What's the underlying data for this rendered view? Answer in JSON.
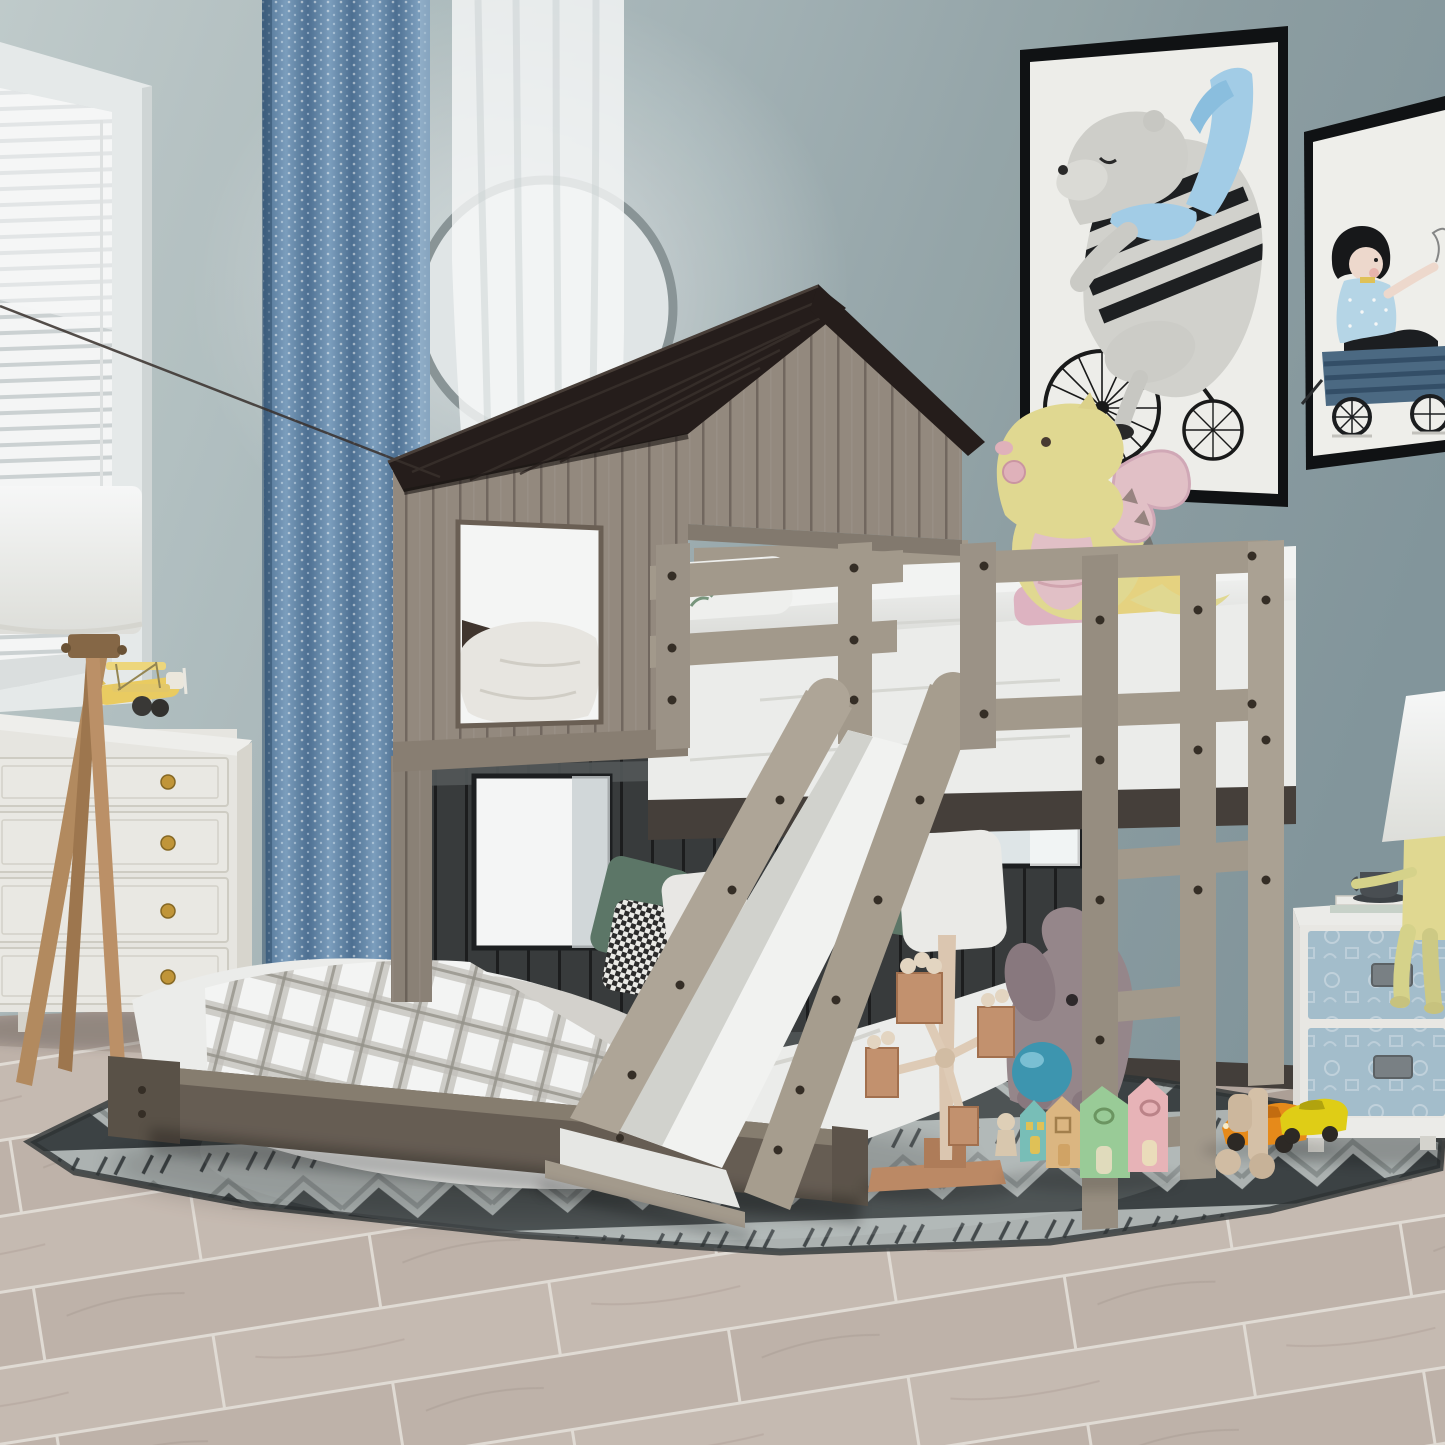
{
  "scene": {
    "description": "Product photo of a kids bedroom: rustic grey playhouse loft bunk bed with dark roof, wooden slide and ladder, full-size lower bed, toys on a grey chevron rug, white dresser with tripod lamp at left, blue nightstand at right, two framed nursery prints on a blue-grey wall.",
    "objects": [
      "venetian-blind-window",
      "blue-patterned-curtain",
      "white-sheer-curtain",
      "round-moon-wall-decor",
      "tripod-floor-lamp",
      "white-dresser",
      "yellow-toy-biplane",
      "bear-on-bicycle-framed-print",
      "boy-in-wagon-framed-print",
      "playhouse-loft-bunk-bed",
      "dark-shingle-roof",
      "upper-loft-mattress",
      "yellow-dragon-plush",
      "wooden-slide",
      "guardrail",
      "ladder",
      "lower-full-bed",
      "plaid-blanket",
      "bolster-pillow",
      "green-pillow",
      "houndstooth-pillow",
      "grey-chevron-rug",
      "plush-elephant",
      "blue-ball",
      "wooden-windmill-toy",
      "pastel-toy-houses",
      "wooden-peg-figure",
      "orange-toy-car",
      "yellow-toy-car",
      "stacked-wood-figure",
      "blue-two-drawer-nightstand",
      "sitting-man-table-lamp",
      "cup-and-books",
      "light-wood-plank-floor"
    ]
  },
  "palette": {
    "wall": "#a7b6b9",
    "wall_light": "#c6d1d1",
    "wall_dark": "#879aa0",
    "curtain_blue": "#5d81a6",
    "sheer": "#f6f8f8",
    "roof": "#261e1b",
    "house_wood": "#988d82",
    "house_wood_dark": "#8d8276",
    "bed_wood": "#a89e90",
    "dark_panel": "#3a3d3e",
    "mattress": "#f4f4f2",
    "slide_white": "#fafaf8",
    "rug_base": "#b2b8b7",
    "rug_dark": "#3e4446",
    "floor": "#c9bcb3",
    "dresser": "#efede8",
    "knob_gold": "#c79a3b",
    "nightstand_blue": "#a9c3d2",
    "lamp_shade": "#fbfaf8",
    "tripod_wood": "#b98e62",
    "dragon_yellow": "#e9df96",
    "dragon_pink": "#eac6cd",
    "elephant": "#9b8a8f",
    "ball_blue": "#3f9ab5",
    "house_teal": "#7cc4bd",
    "house_tan": "#e3bc85",
    "house_green": "#9fd29c",
    "house_pink": "#f0b9bd",
    "car_orange": "#ef8f1a",
    "car_yellow": "#e8d416",
    "plane_yellow": "#f2d264",
    "frame_black": "#101214",
    "scarf_blue": "#a8d3ee",
    "pillow_green": "#5f7a6a",
    "footboard": "#6a6056",
    "baseboard": "#4a3b31"
  }
}
